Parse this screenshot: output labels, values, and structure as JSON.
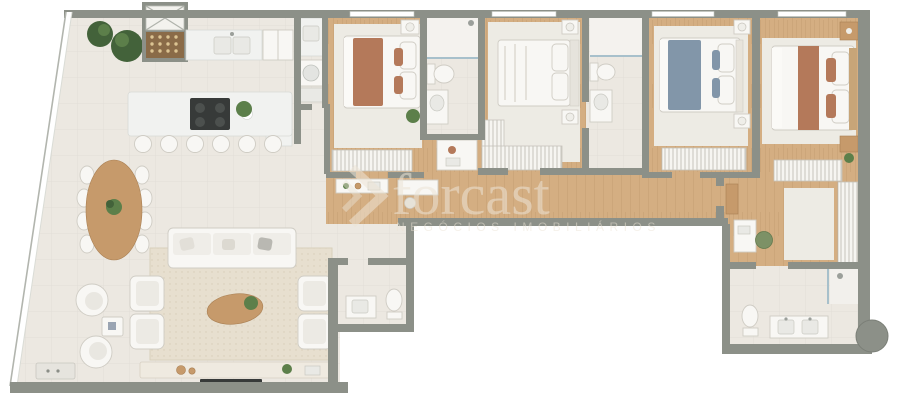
{
  "watermark": {
    "brand": "forcast",
    "tagline": "NEGÓCIOS IMOBILIÁRIOS"
  },
  "colors": {
    "outside": "#ffffff",
    "wall": "#8c9088",
    "wood": "#d4ae82",
    "woodline": "#a8release",
    "tile": "#ece8e1",
    "rug": "#e7dfcf",
    "rugbed": "#edebe4",
    "marble": "#f1f2f0",
    "white": "#f8f7f4",
    "stroke": "#cfccc4",
    "woodfurn": "#c69a6b",
    "terracotta": "#b4795a",
    "blue": "#8296a9",
    "plant": "#5c7f4a",
    "plantdark": "#43623a",
    "dark": "#373a39",
    "glass": "#a7c0cb",
    "watermark": "#ece4d6"
  }
}
